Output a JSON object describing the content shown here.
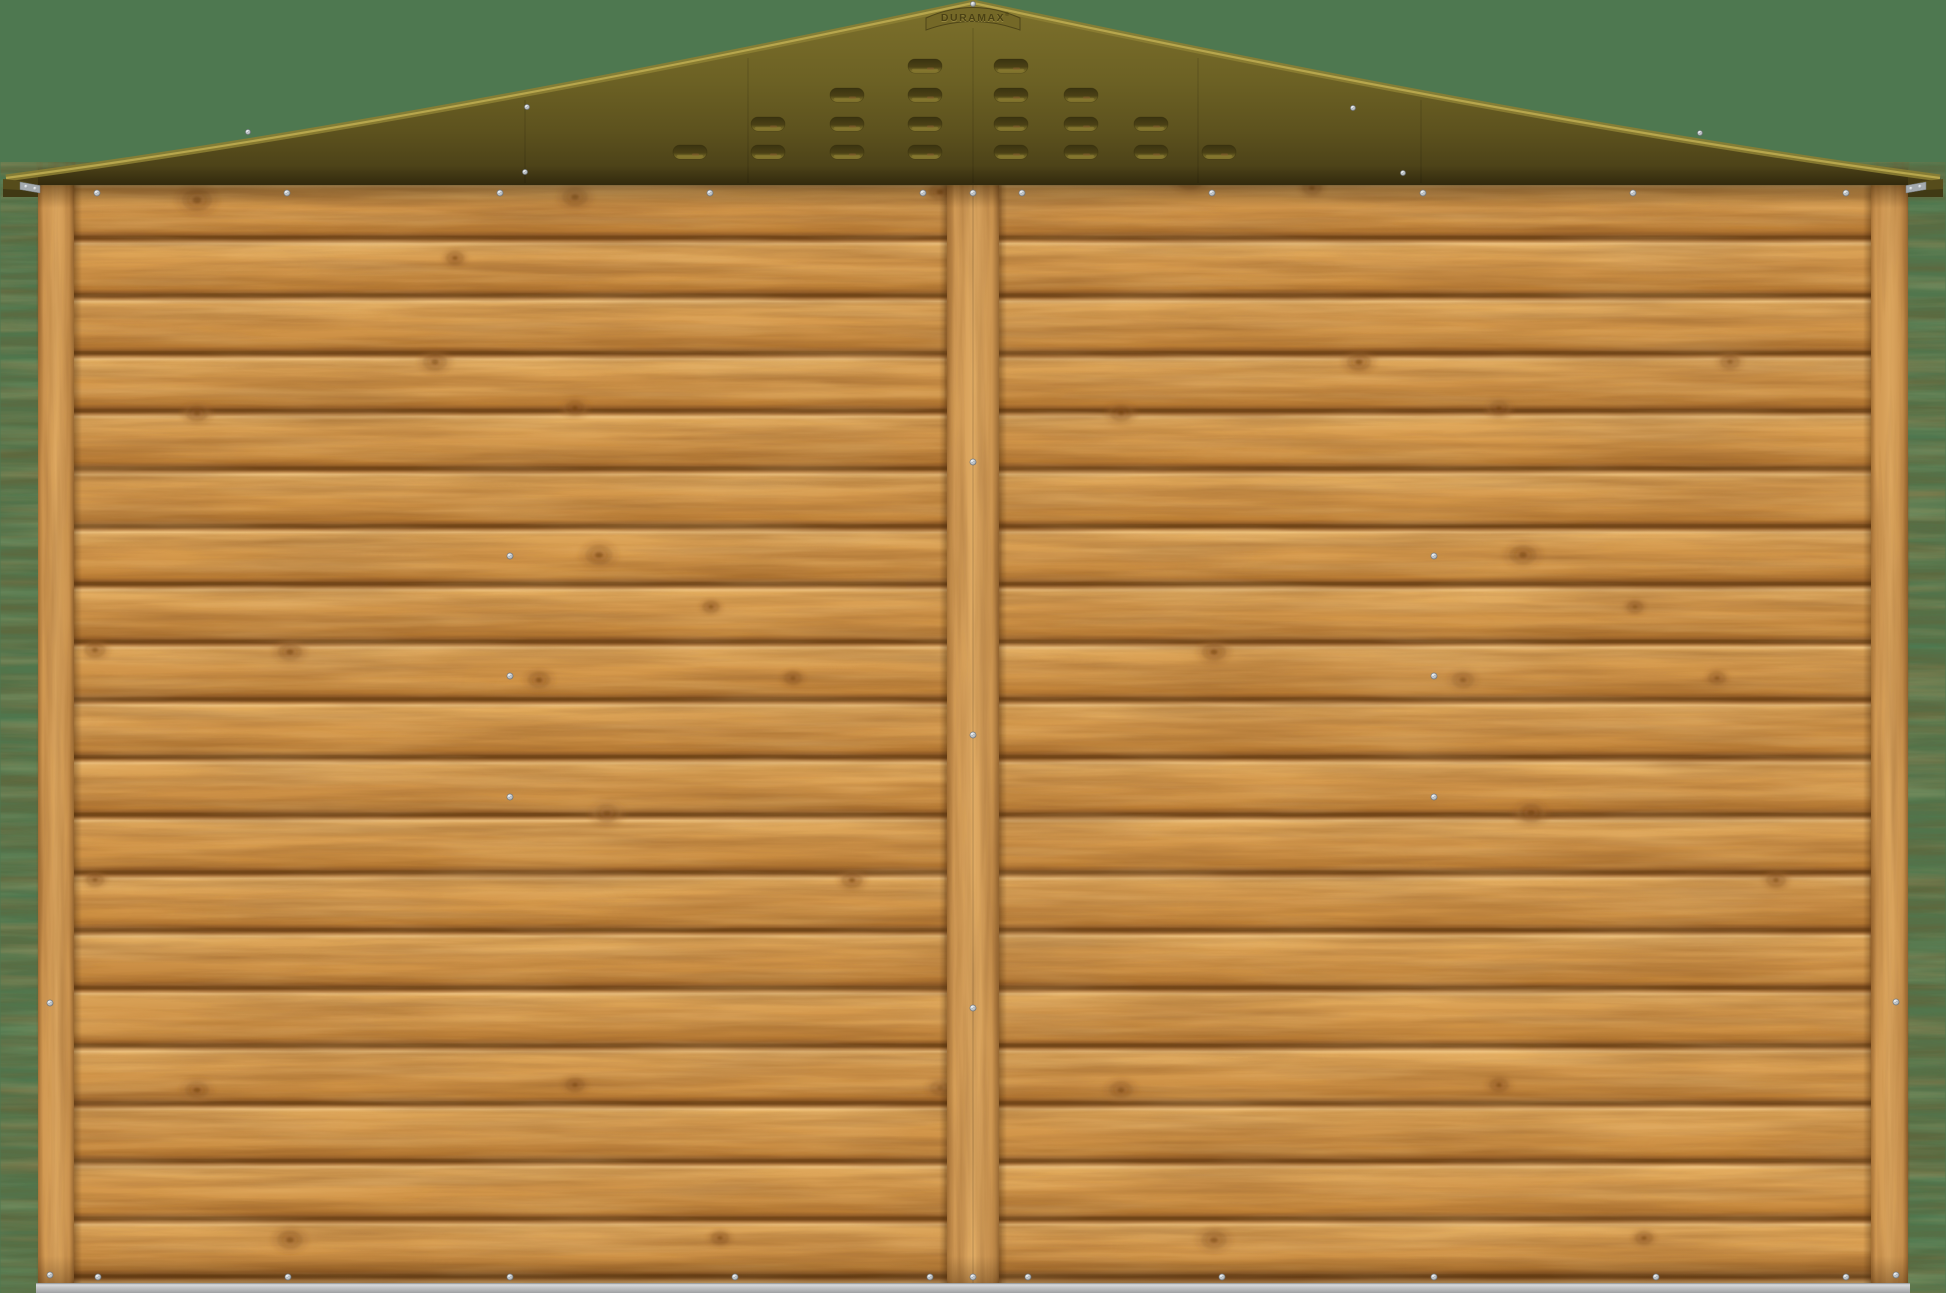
{
  "scene": {
    "description": "3D product render of a wooden garden shed wall (horizontal shiplap planks, three vertical battens) with an olive-green metal apex roof with louvered vents, on a sage-green backdrop",
    "background_color": "#4e7850"
  },
  "roof": {
    "brand": "DURAMAX",
    "registered_mark": "®",
    "color_ridge": "#7d712c",
    "color_main": "#6c6124",
    "color_eave": "#3f3512",
    "edge_highlight": "#b9a94f",
    "apex": {
      "x": 973,
      "y": 3
    },
    "left_tip_x": 6,
    "right_tip_x": 1940,
    "eave_bottom_y": 185.5,
    "vents": {
      "slot_width": 34,
      "slot_height": 14,
      "row_centers_y": [
        66,
        95,
        124,
        152
      ],
      "columns": [
        {
          "cx": 690,
          "slots": 1
        },
        {
          "cx": 768,
          "slots": 2
        },
        {
          "cx": 847,
          "slots": 3
        },
        {
          "cx": 925,
          "slots": 4
        },
        {
          "cx": 1011,
          "slots": 4
        },
        {
          "cx": 1081,
          "slots": 3
        },
        {
          "cx": 1151,
          "slots": 2
        },
        {
          "cx": 1219,
          "slots": 1
        }
      ]
    },
    "seams": [
      [
        525,
        100
      ],
      [
        748,
        58
      ],
      [
        973,
        28
      ],
      [
        1198,
        58
      ],
      [
        1421,
        100
      ]
    ],
    "screws": [
      [
        973,
        4
      ],
      [
        527,
        107
      ],
      [
        1353,
        108
      ],
      [
        248,
        132
      ],
      [
        1700,
        133
      ],
      [
        525,
        172
      ],
      [
        1403,
        173
      ]
    ]
  },
  "wall": {
    "left": 38,
    "right": 1908,
    "top": 184,
    "bottom": 1283,
    "plank_pitch": 57.7,
    "plank_count": 19,
    "wood_light": "#eec27f",
    "wood_mid": "#d89c4f",
    "wood_dark": "#bd7f36",
    "gap_color": "#6f4418",
    "posts": [
      {
        "label": "left-post",
        "x": 38,
        "w": 36
      },
      {
        "label": "center-post",
        "x": 947,
        "w": 52
      },
      {
        "label": "right-post",
        "x": 1871,
        "w": 37
      }
    ],
    "screws": [
      [
        97,
        193
      ],
      [
        287,
        193
      ],
      [
        500,
        193
      ],
      [
        710,
        193
      ],
      [
        923,
        193
      ],
      [
        973,
        193
      ],
      [
        1022,
        193
      ],
      [
        1212,
        193
      ],
      [
        1423,
        193
      ],
      [
        1633,
        193
      ],
      [
        1846,
        193
      ],
      [
        510,
        556
      ],
      [
        510,
        676
      ],
      [
        510,
        797
      ],
      [
        1434,
        556
      ],
      [
        1434,
        676
      ],
      [
        1434,
        797
      ],
      [
        973,
        462
      ],
      [
        973,
        735
      ],
      [
        973,
        1008
      ],
      [
        50,
        1003
      ],
      [
        50,
        1275
      ],
      [
        1896,
        1002
      ],
      [
        1896,
        1275
      ],
      [
        98,
        1277
      ],
      [
        288,
        1277
      ],
      [
        510,
        1277
      ],
      [
        735,
        1277
      ],
      [
        930,
        1277
      ],
      [
        973,
        1277
      ],
      [
        1028,
        1277
      ],
      [
        1222,
        1277
      ],
      [
        1434,
        1277
      ],
      [
        1656,
        1277
      ],
      [
        1846,
        1277
      ]
    ],
    "knots": [
      [
        197,
        200,
        1.0
      ],
      [
        575,
        197,
        0.85
      ],
      [
        455,
        258,
        0.6
      ],
      [
        940,
        192,
        0.75
      ],
      [
        1190,
        180,
        0.9
      ],
      [
        1312,
        188,
        0.65
      ],
      [
        435,
        362,
        0.8
      ],
      [
        197,
        413,
        0.75
      ],
      [
        575,
        408,
        0.7
      ],
      [
        1359,
        362,
        0.8
      ],
      [
        1121,
        413,
        0.75
      ],
      [
        1499,
        408,
        0.7
      ],
      [
        1730,
        362,
        0.65
      ],
      [
        599,
        555,
        0.9
      ],
      [
        711,
        607,
        0.55
      ],
      [
        539,
        680,
        0.75
      ],
      [
        793,
        678,
        0.6
      ],
      [
        607,
        813,
        0.85
      ],
      [
        1523,
        555,
        0.9
      ],
      [
        1635,
        607,
        0.55
      ],
      [
        1463,
        680,
        0.75
      ],
      [
        1717,
        678,
        0.6
      ],
      [
        1531,
        813,
        0.85
      ],
      [
        95,
        650,
        0.7
      ],
      [
        290,
        652,
        0.8
      ],
      [
        1214,
        652,
        0.8
      ],
      [
        95,
        880,
        0.6
      ],
      [
        852,
        880,
        0.7
      ],
      [
        1776,
        880,
        0.65
      ],
      [
        197,
        1090,
        0.8
      ],
      [
        575,
        1085,
        0.65
      ],
      [
        940,
        1088,
        0.7
      ],
      [
        1121,
        1090,
        0.8
      ],
      [
        1499,
        1085,
        0.65
      ],
      [
        290,
        1240,
        0.85
      ],
      [
        720,
        1238,
        0.6
      ],
      [
        1214,
        1240,
        0.85
      ],
      [
        1644,
        1238,
        0.6
      ]
    ]
  },
  "base_rail": {
    "x": 36,
    "y": 1283,
    "w": 1874,
    "h": 10,
    "color": "#c3c5c7"
  }
}
